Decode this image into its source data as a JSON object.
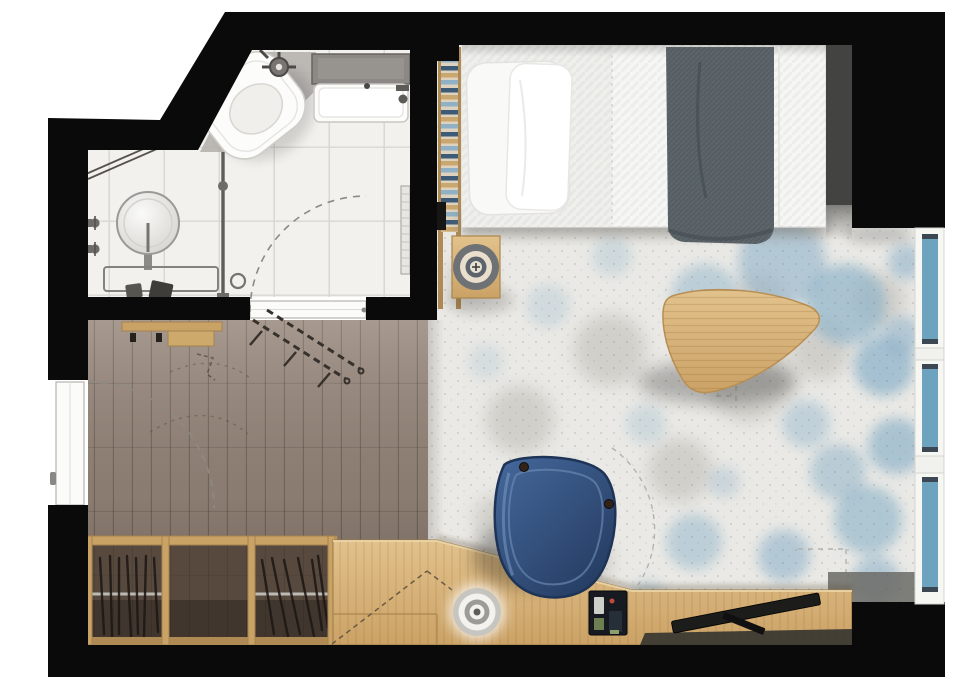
{
  "meta": {
    "type": "apartment-floor-plan-top-view",
    "rooms": [
      "bathroom",
      "entry-hall",
      "bed-living-room"
    ],
    "style": "rendered color plan, black walls, no text labels"
  },
  "colors": {
    "wall": "#0a0a0a",
    "exterior": "#ffffff",
    "bathroomTile": "#f2f1ed",
    "bathroomGrout": "#d8d6d1",
    "showerFloor": "#b6b3ae",
    "bathtubDeck": "#8b8885",
    "porcelain": "#fcfcfa",
    "fixtureMetal": "#6e6c69",
    "hallWood": "#96867a",
    "hallWoodDark": "#6b5e53",
    "wardrobeInterior": "#57493d",
    "woodFrame": "#c9a266",
    "deskWood": "#d9b77f",
    "deskWoodDark": "#c3995c",
    "rugBase": "#eae9e5",
    "rugBlue": "#8fb3c9",
    "rugGray": "#c1c0ba",
    "windowFrame": "#f6f6f3",
    "windowGlass": "#6ea3bf",
    "windowGlassDark": "#3b4854",
    "chairBlue": "#35598a",
    "chairBlueDark": "#1e3457",
    "blanketGray": "#555e63",
    "beddingWhite": "#f6f6f4",
    "tvBlack": "#1c1c1a",
    "ladderRungBlue": "#3d5a76",
    "ladderRungTan": "#c9a76e",
    "arcLine": "#8d8a84",
    "doorLeaf": "#fbfbf9"
  },
  "windows": {
    "pane_count": 3,
    "location": "right-wall"
  },
  "inventory": {
    "bathroom": [
      "corner-toilet",
      "bathtub-with-deck",
      "round-pedestal-basin",
      "wall-taps",
      "shower-head",
      "shower-glass-partition",
      "standpipe",
      "towel-radiator",
      "bathroom-door-swing"
    ],
    "entry_hall": [
      "entry-door",
      "door-swing-arc",
      "coat-rack-with-hooks",
      "folding-luggage-rack",
      "open-wardrobe-two-hanger-sections"
    ],
    "bed_living_room": [
      "double-bed-with-two-pillows",
      "gray-throw-blanket",
      "ladder-shelf",
      "bedside-table-with-round-tray",
      "pick-shaped-coffee-table",
      "blue-mottled-area-rug",
      "angled-desk",
      "blue-desk-chair",
      "flat-tv-on-desk",
      "phone-dock",
      "round-desk-tray",
      "three-pane-window-wall"
    ]
  }
}
